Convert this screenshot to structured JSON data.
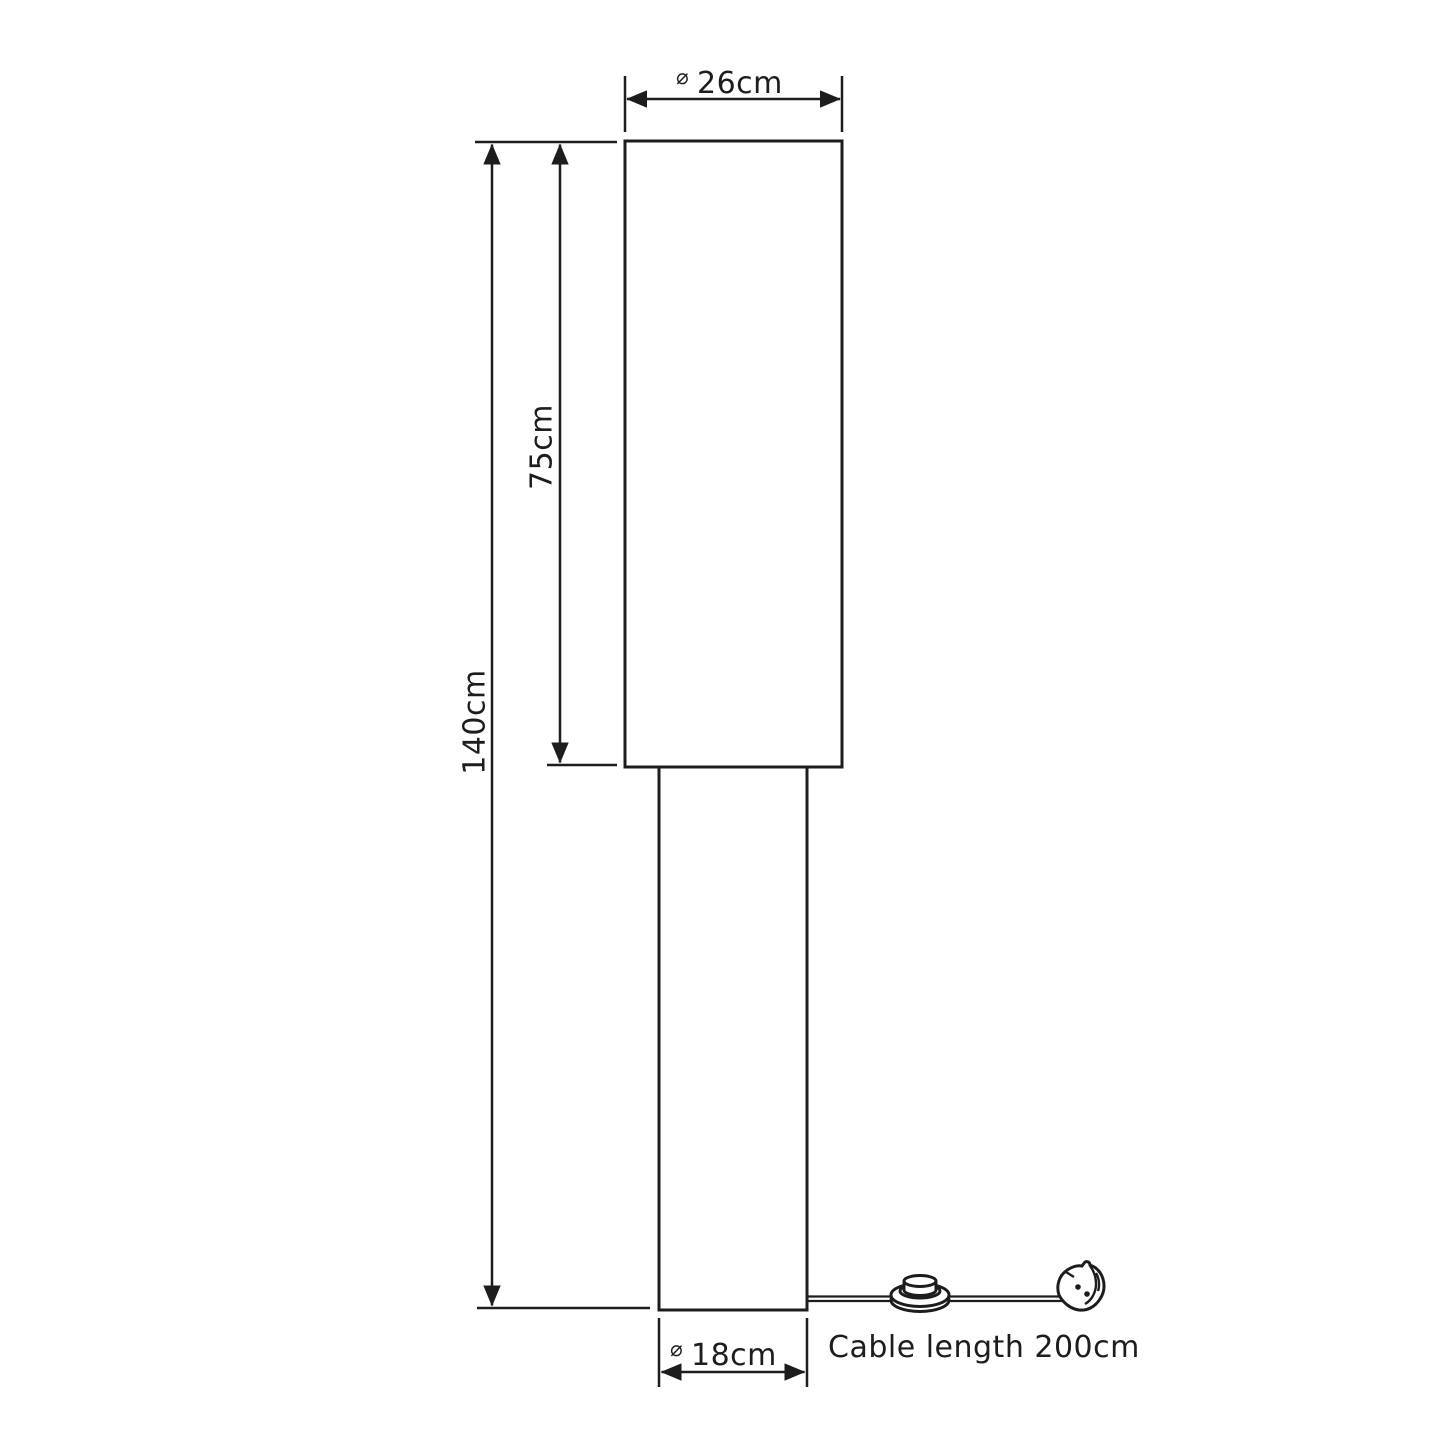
{
  "diagram": {
    "background": "#ffffff",
    "line_color": "#1d1d1b",
    "labels": {
      "diameter_symbol": "⌀",
      "shade_diameter": "26cm",
      "shade_height": "75cm",
      "total_height": "140cm",
      "base_diameter": "18cm",
      "cable_note": "Cable length 200cm"
    },
    "parts": {
      "shade": "lamp-shade",
      "pole": "lamp-pole",
      "cable": "power-cable",
      "switch": "foot-switch",
      "plug": "uk-plug"
    }
  }
}
